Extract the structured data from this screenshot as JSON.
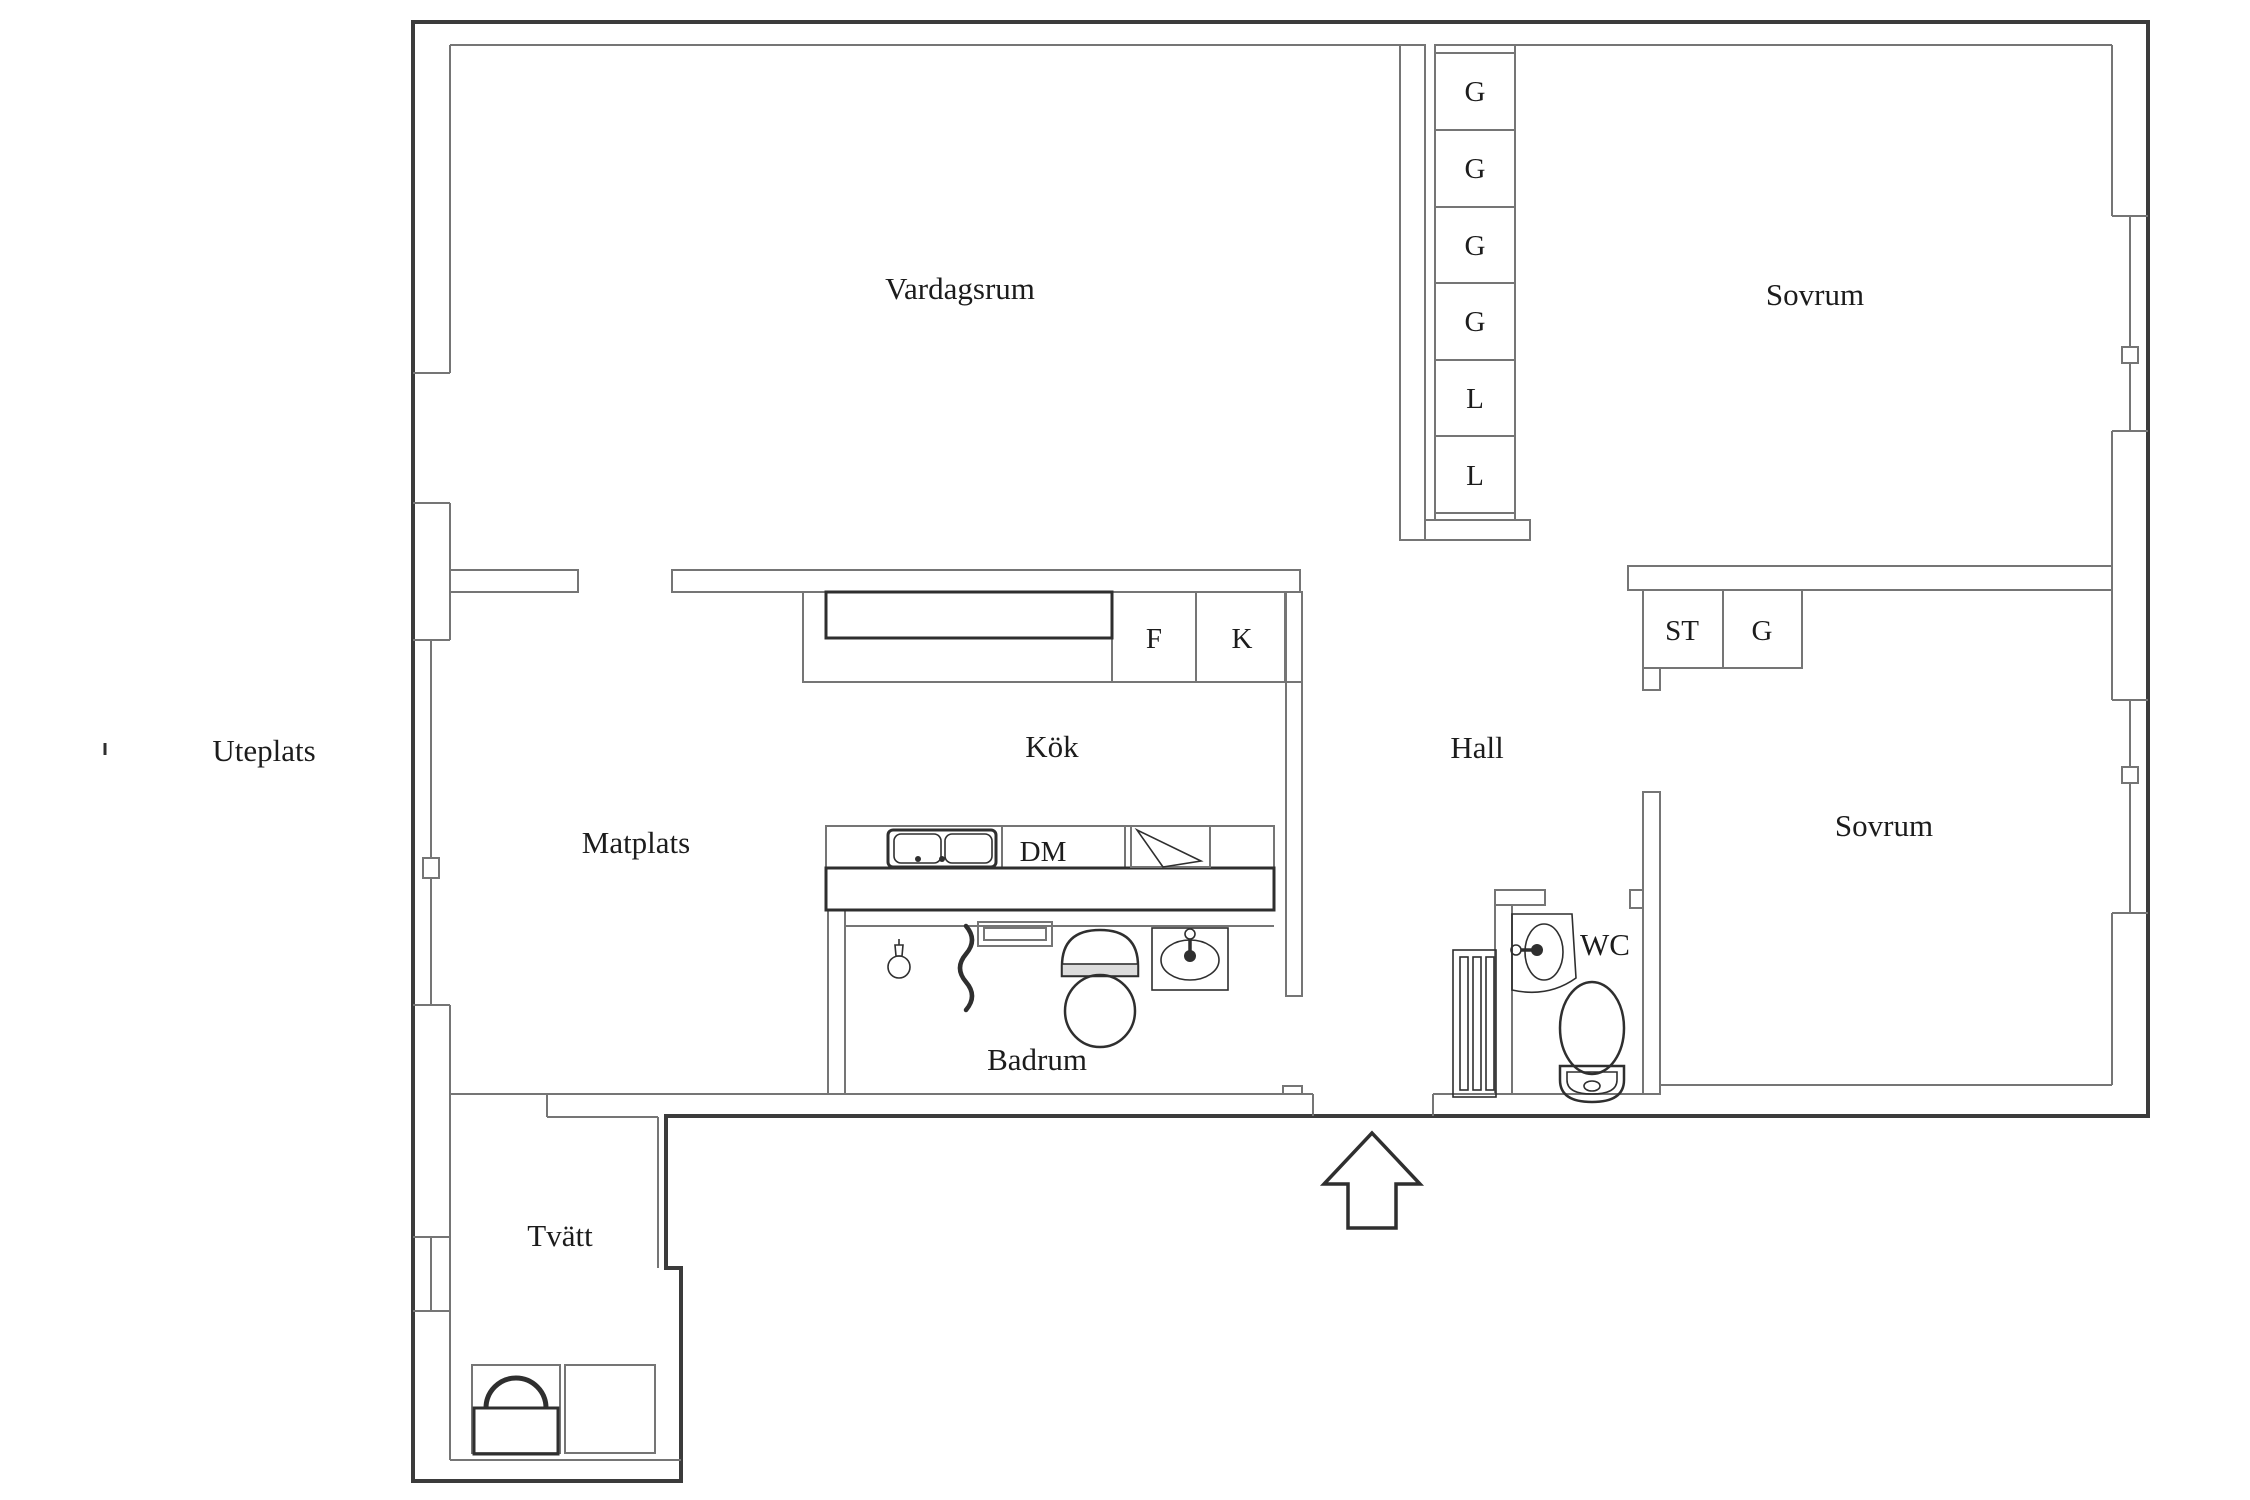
{
  "colors": {
    "background": "#ffffff",
    "wall_thin": "#757575",
    "wall_dark": "#3b3b3b",
    "fixture": "#2f2f2f",
    "label_text": "#1c1c1c"
  },
  "rooms": [
    {
      "id": "vardagsrum",
      "label": "Vardagsrum"
    },
    {
      "id": "sovrum-1",
      "label": "Sovrum"
    },
    {
      "id": "kok",
      "label": "Kök"
    },
    {
      "id": "hall",
      "label": "Hall"
    },
    {
      "id": "matplats",
      "label": "Matplats"
    },
    {
      "id": "sovrum-2",
      "label": "Sovrum"
    },
    {
      "id": "badrum",
      "label": "Badrum"
    },
    {
      "id": "wc",
      "label": "WC"
    },
    {
      "id": "tvatt",
      "label": "Tvätt"
    },
    {
      "id": "uteplats",
      "label": "Uteplats"
    }
  ],
  "storage": {
    "tall_cabinets": [
      {
        "label": "G"
      },
      {
        "label": "G"
      },
      {
        "label": "G"
      },
      {
        "label": "G"
      },
      {
        "label": "L"
      },
      {
        "label": "L"
      }
    ],
    "hall_cabinets": [
      {
        "label": "ST"
      },
      {
        "label": "G"
      }
    ],
    "kitchen_units": [
      {
        "label": "F"
      },
      {
        "label": "K"
      },
      {
        "label": "DM"
      }
    ]
  }
}
